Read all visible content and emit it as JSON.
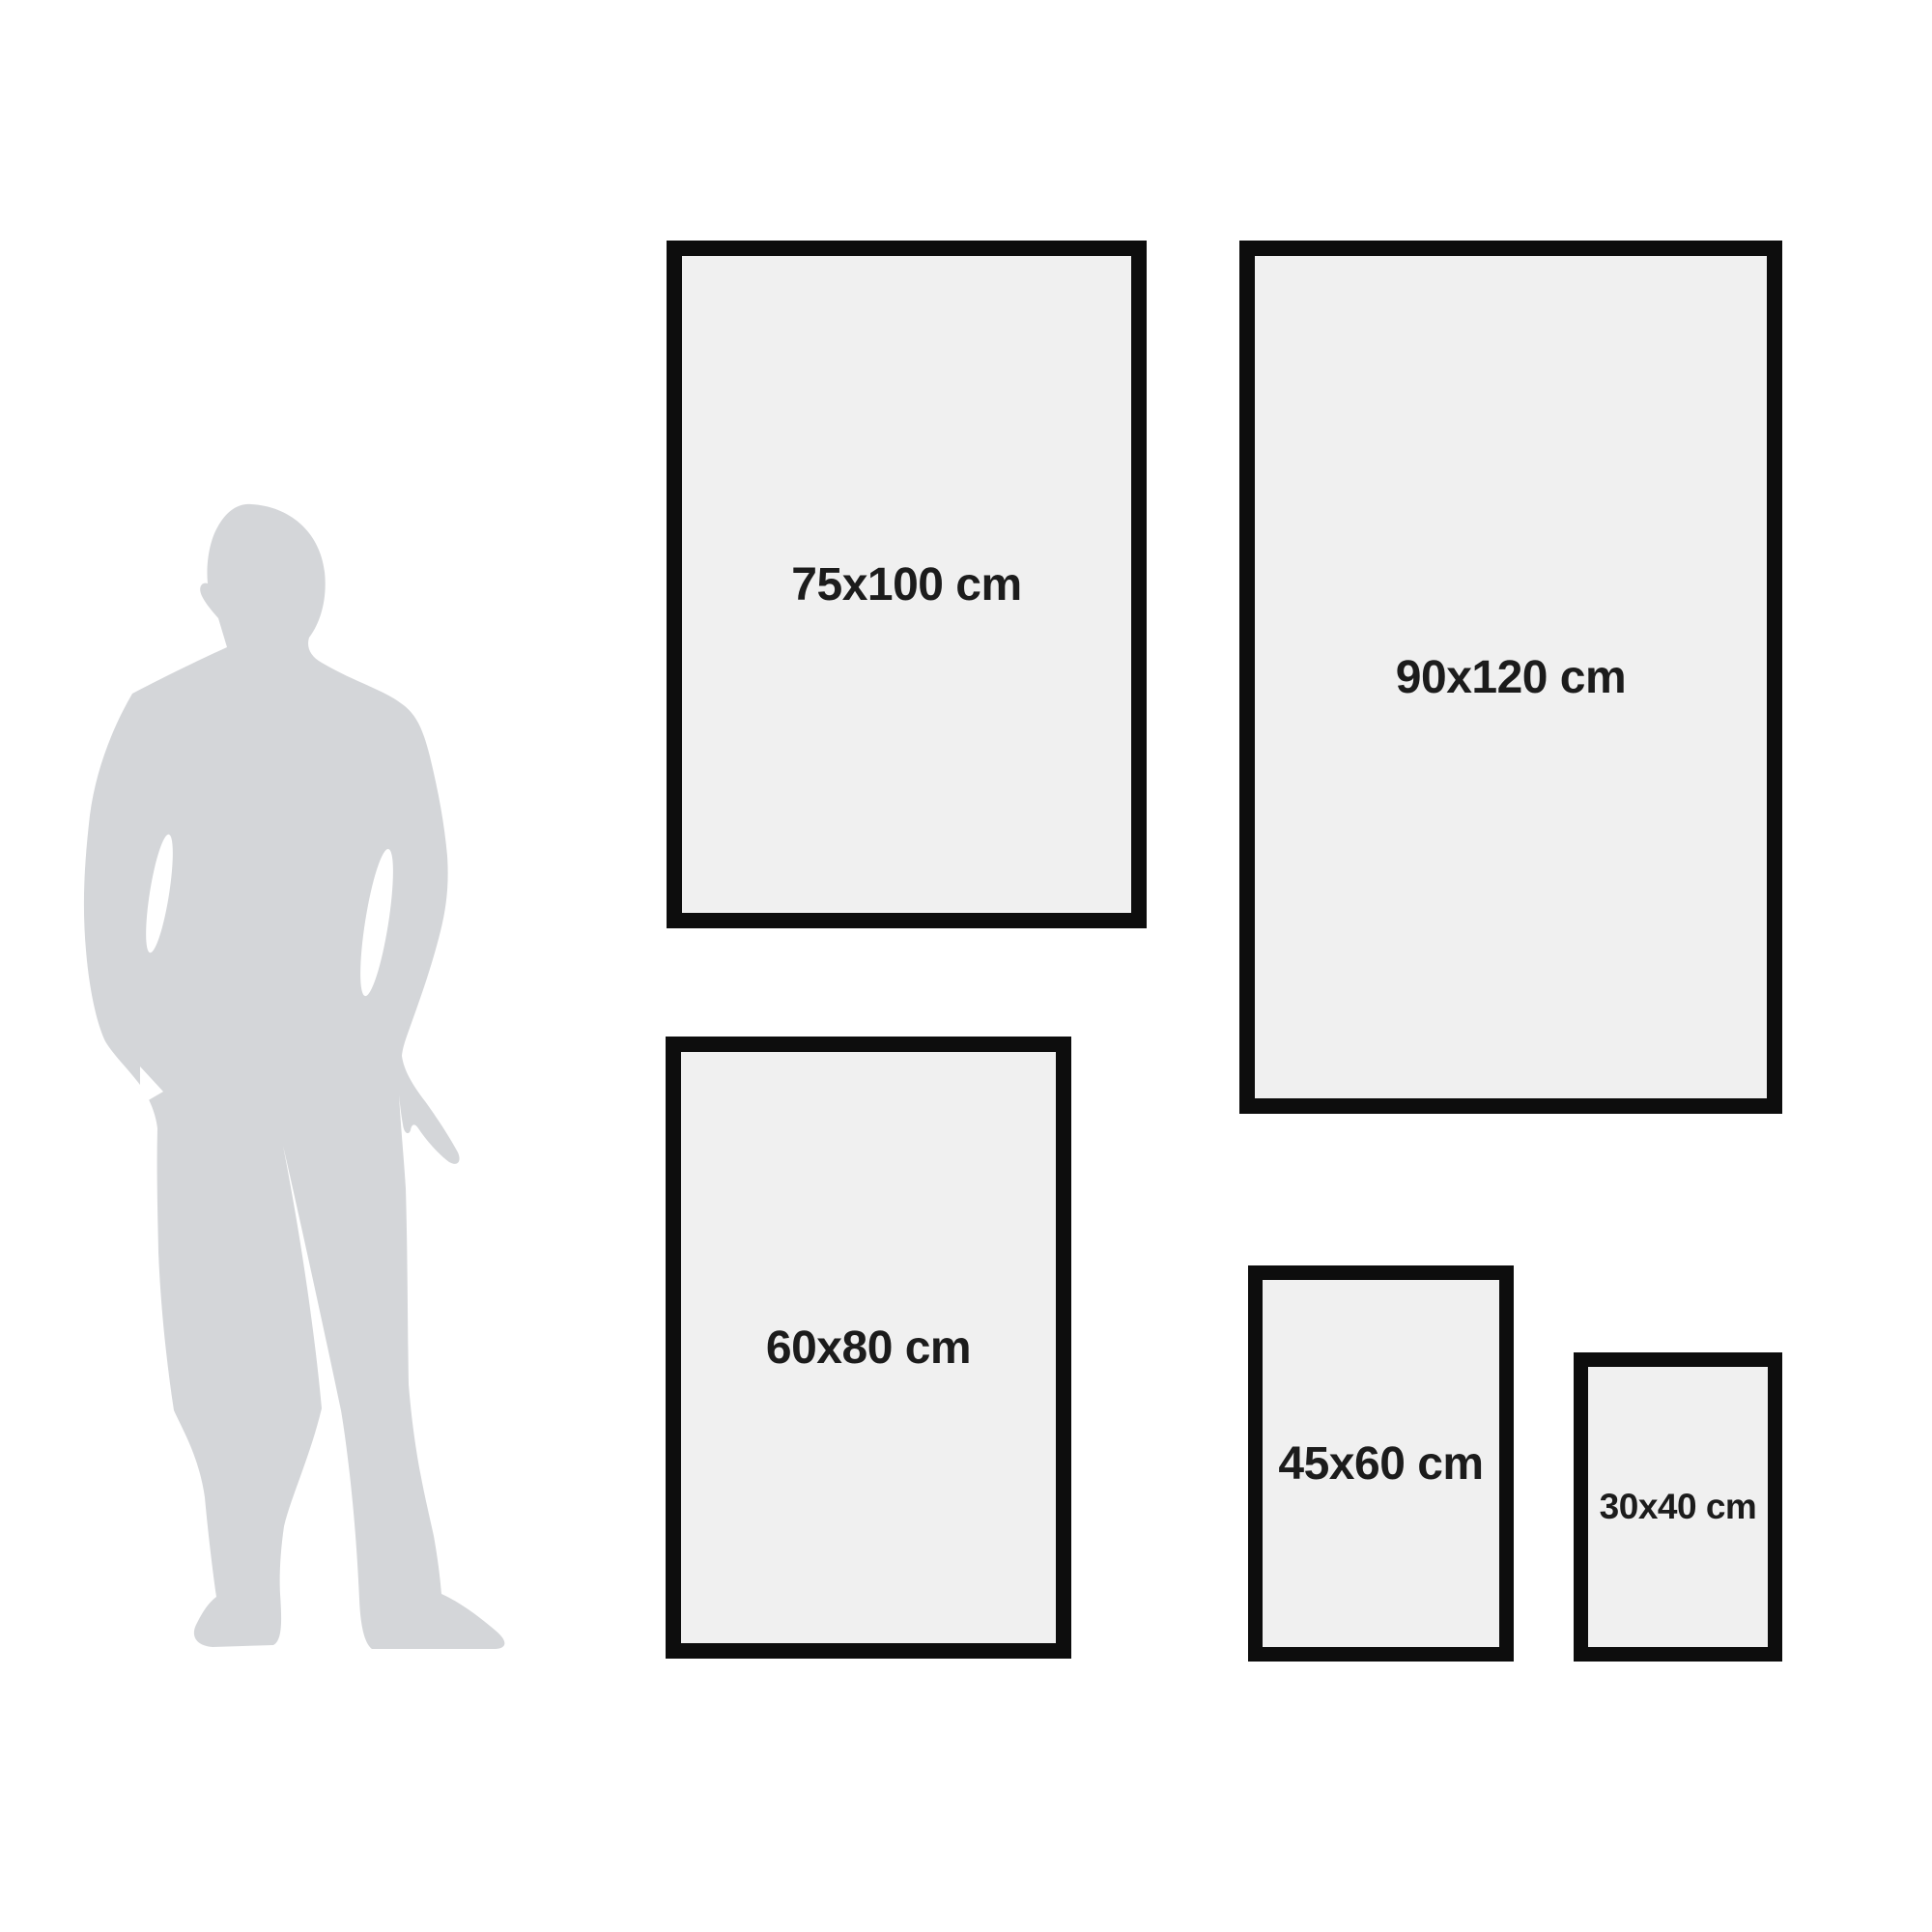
{
  "palette": {
    "background": "#ffffff",
    "frame_border": "#0d0d0d",
    "frame_fill": "#f0f0f0",
    "label_color": "#1c1c1c",
    "silhouette_color": "#d4d6d9"
  },
  "icons": [
    {
      "name": "person-silhouette",
      "glyph": "standing-man-in-suit"
    }
  ],
  "frames": [
    {
      "label": "75x100 cm",
      "width_cm": 75,
      "height_cm": 100
    },
    {
      "label": "90x120 cm",
      "width_cm": 90,
      "height_cm": 120
    },
    {
      "label": "60x80 cm",
      "width_cm": 60,
      "height_cm": 80
    },
    {
      "label": "45x60 cm",
      "width_cm": 45,
      "height_cm": 60
    },
    {
      "label": "30x40 cm",
      "width_cm": 30,
      "height_cm": 40
    }
  ]
}
